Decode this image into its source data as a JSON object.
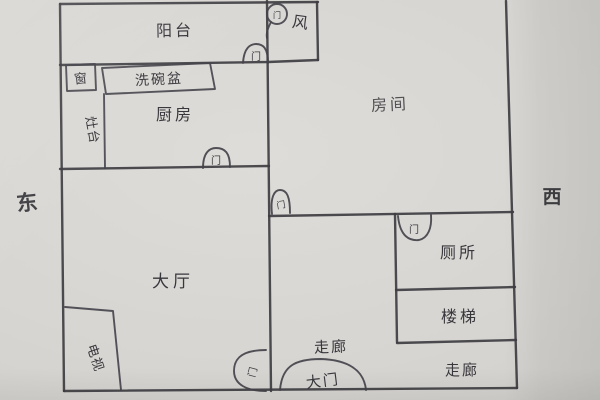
{
  "compass": {
    "east": "东",
    "west": "西"
  },
  "rooms": {
    "balcony": "阳台",
    "kitchen": "厨房",
    "bedroom": "房间",
    "hall": "大厅",
    "toilet": "厕所",
    "stairs": "楼梯",
    "corridor_middle": "走廊",
    "corridor_bottom": "走廊"
  },
  "fixtures": {
    "sink_counter": "洗碗盆",
    "stove_counter": "灶台",
    "tv_cabinet": "电视",
    "corner_box": "窗",
    "wind_mark": "风"
  },
  "doors": {
    "door_label": "门",
    "main_door_label": "大门"
  },
  "colors": {
    "paper": "#d7d5d1",
    "ink": "#3e3d41"
  }
}
